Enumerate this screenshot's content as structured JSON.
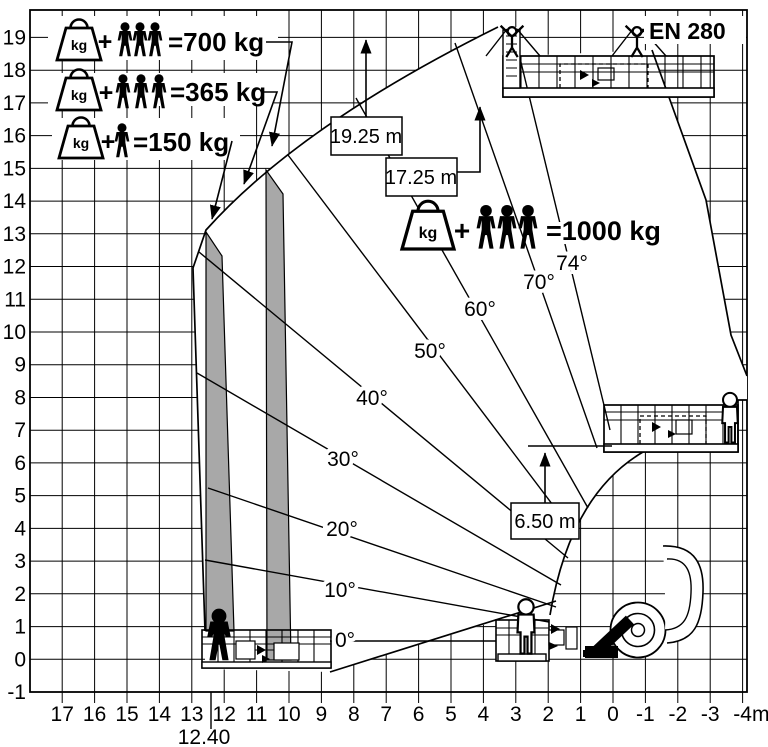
{
  "title": "Aerial work platform working envelope load diagram",
  "standard": "EN 280",
  "ui": {
    "plus": "+",
    "kg": "kg"
  },
  "legend": {
    "rows": [
      {
        "icon": "kg-weight",
        "persons": 3,
        "label": "=700 kg"
      },
      {
        "icon": "kg-weight",
        "persons": 3,
        "label": "=365 kg"
      },
      {
        "icon": "kg-weight",
        "persons": 1,
        "label": "=150 kg"
      }
    ]
  },
  "platform_load": {
    "icon": "kg-weight",
    "persons": 3,
    "label": "=1000 kg"
  },
  "heights": {
    "max_working_height": "19.25 m",
    "upper_platform": "17.25 m",
    "mid_platform": "6.50 m"
  },
  "angles": {
    "labels": [
      "0°",
      "10°",
      "20°",
      "30°",
      "40°",
      "50°",
      "60°",
      "70°",
      "74°"
    ]
  },
  "axes": {
    "y_ticks": [
      "19",
      "18",
      "17",
      "16",
      "15",
      "14",
      "13",
      "12",
      "11",
      "10",
      "9",
      "8",
      "7",
      "6",
      "5",
      "4",
      "3",
      "2",
      "1",
      "0",
      "-1"
    ],
    "x_ticks": [
      "17",
      "16",
      "15",
      "14",
      "13",
      "12",
      "11",
      "10",
      "9",
      "8",
      "7",
      "6",
      "5",
      "4",
      "3",
      "2",
      "1",
      "0",
      "-1",
      "-2",
      "-3",
      "-4"
    ],
    "x_unit": "m",
    "max_outreach": "12.40"
  },
  "chart_data": {
    "type": "working-envelope-diagram",
    "standard": "EN 280",
    "units": "m",
    "x_axis": {
      "ticks": [
        17,
        16,
        15,
        14,
        13,
        12,
        11,
        10,
        9,
        8,
        7,
        6,
        5,
        4,
        3,
        2,
        1,
        0,
        -1,
        -2,
        -3,
        -4
      ],
      "unit": "m",
      "max_outreach_m": 12.4
    },
    "y_axis": {
      "ticks": [
        19,
        18,
        17,
        16,
        15,
        14,
        13,
        12,
        11,
        10,
        9,
        8,
        7,
        6,
        5,
        4,
        3,
        2,
        1,
        0,
        -1
      ],
      "unit": "m"
    },
    "boom_angles_deg": [
      0,
      10,
      20,
      30,
      40,
      50,
      60,
      70,
      74
    ],
    "key_heights_m": {
      "max_working_height": 19.25,
      "upper_platform_floor": 17.25,
      "intermediate_platform_floor": 6.5
    },
    "load_capacity_zones": [
      {
        "capacity_kg": 1000,
        "persons": 3,
        "zone": "inner envelope"
      },
      {
        "capacity_kg": 700,
        "persons": 3,
        "zone": "first outreach band"
      },
      {
        "capacity_kg": 365,
        "persons": 3,
        "zone": "second outreach band"
      },
      {
        "capacity_kg": 150,
        "persons": 1,
        "zone": "maximum outreach band"
      }
    ],
    "grid": true
  }
}
